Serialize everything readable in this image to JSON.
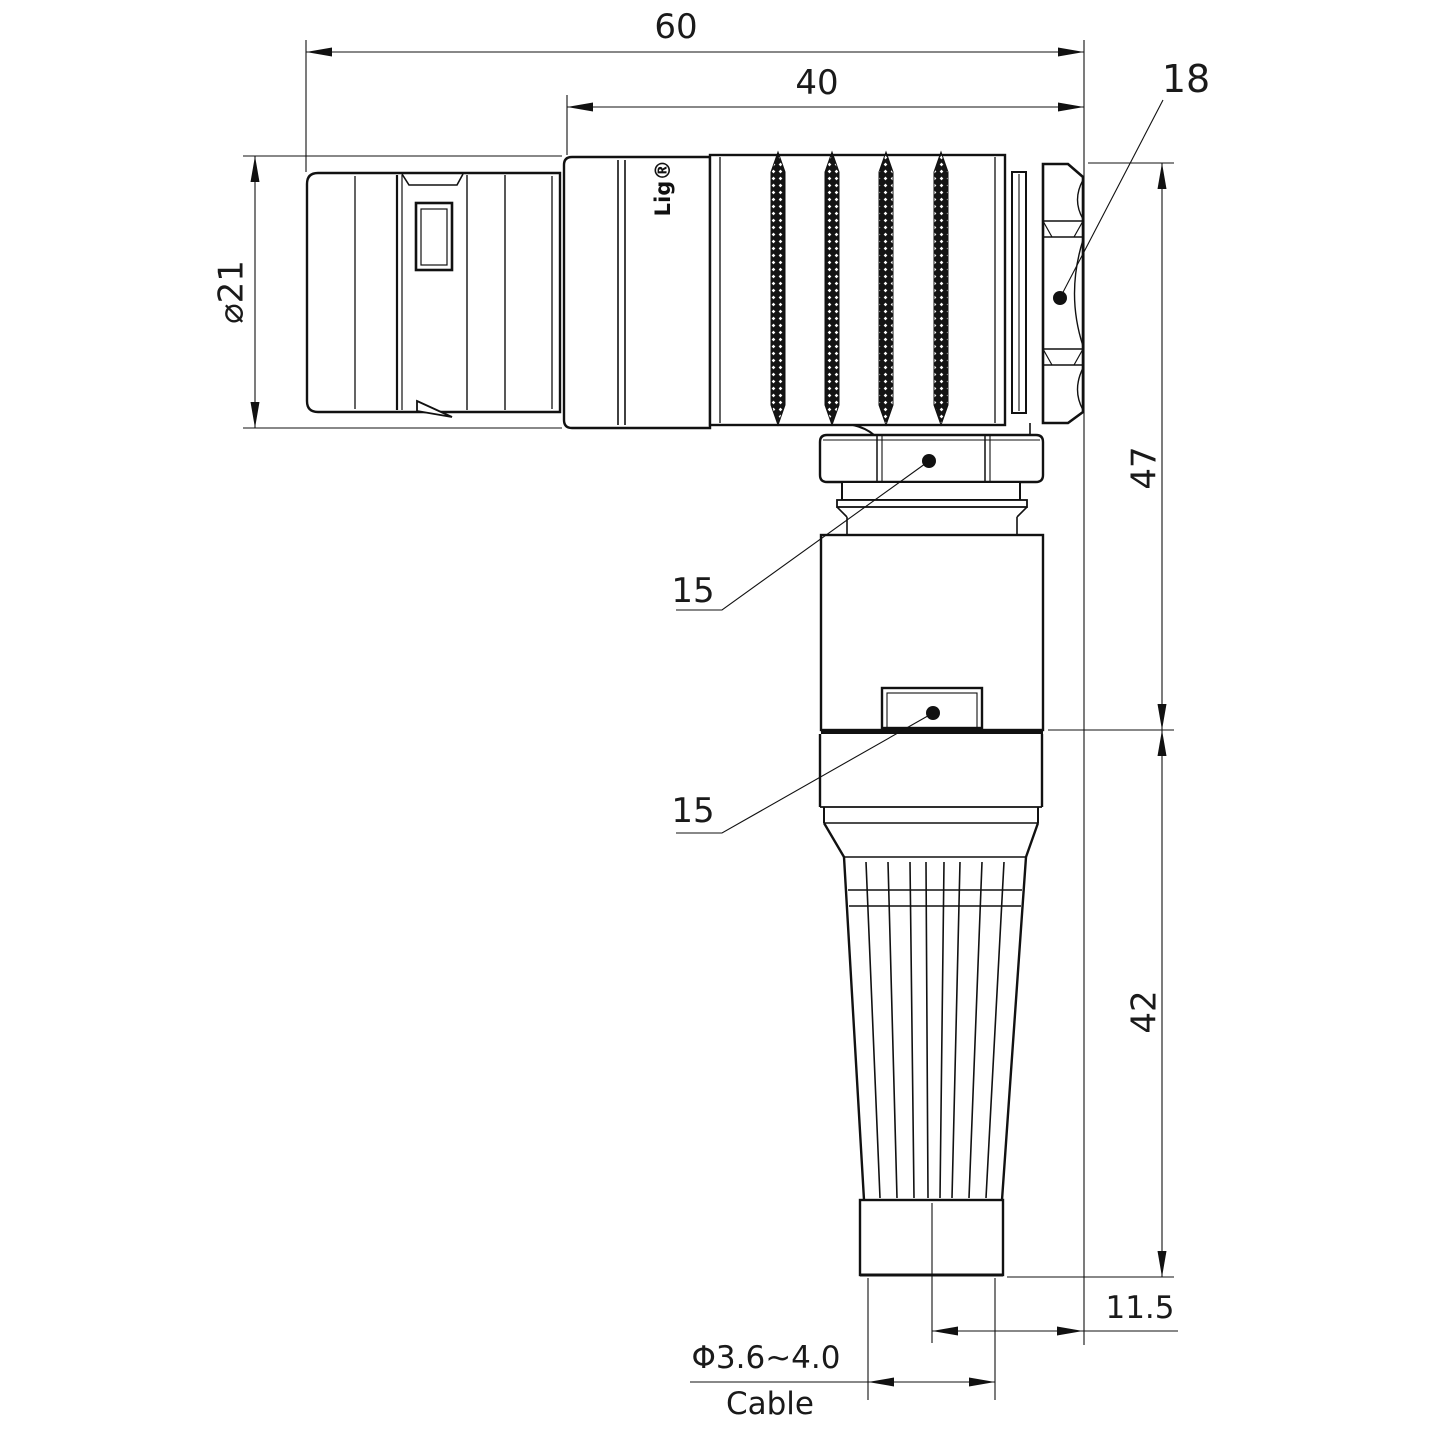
{
  "drawing": {
    "watermark": "Lightany",
    "engraving": "Lig®",
    "dimensions": {
      "overall_length": "60",
      "rear_length": "40",
      "hex_width": "18",
      "plug_diameter": "⌀21",
      "upper_height": "47",
      "lower_height": "42",
      "cable_offset": "11.5",
      "cable_diameter": "Φ3.6~4.0",
      "cable_label": "Cable",
      "coupling_nut_callout": "15",
      "body_window_callout": "15"
    }
  }
}
